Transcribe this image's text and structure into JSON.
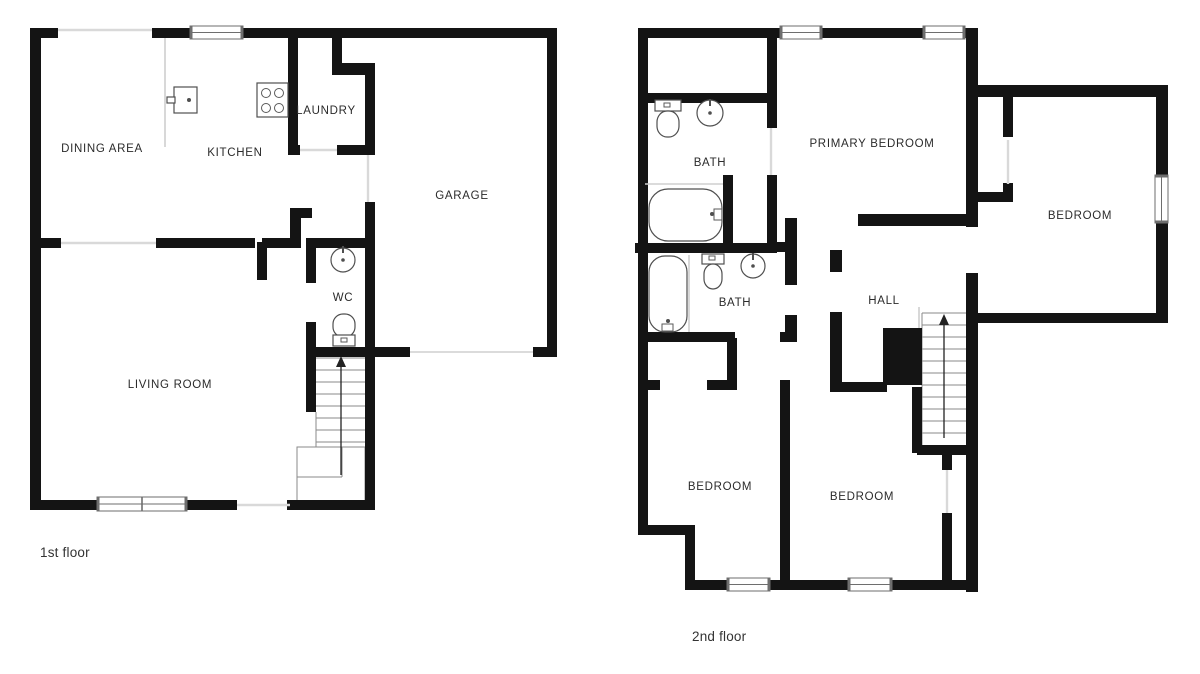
{
  "document": {
    "type": "floor-plan",
    "background": "#ffffff"
  },
  "colors": {
    "wall": "#141414",
    "window_frame": "#6e6e6e",
    "opening_line": "#d9d9d9",
    "label": "#2b2b2b"
  },
  "floor1": {
    "caption": "1st floor",
    "rooms": {
      "dining": {
        "label": "DINING AREA"
      },
      "kitchen": {
        "label": "KITCHEN"
      },
      "laundry": {
        "label": "LAUNDRY"
      },
      "garage": {
        "label": "GARAGE"
      },
      "wc": {
        "label": "WC"
      },
      "living": {
        "label": "LIVING ROOM"
      }
    },
    "fixtures": [
      "kitchen-sink",
      "stove",
      "wc-sink",
      "toilet",
      "staircase-up"
    ],
    "windows": 2,
    "stair_direction": "up"
  },
  "floor2": {
    "caption": "2nd floor",
    "rooms": {
      "bath_upper": {
        "label": "BATH"
      },
      "primary": {
        "label": "PRIMARY BEDROOM"
      },
      "bedroom_right": {
        "label": "BEDROOM"
      },
      "bath_lower": {
        "label": "BATH"
      },
      "hall": {
        "label": "HALL"
      },
      "bedroom_sw": {
        "label": "BEDROOM"
      },
      "bedroom_se": {
        "label": "BEDROOM"
      }
    },
    "fixtures": [
      "toilet",
      "sink",
      "bathtub",
      "bathtub",
      "toilet",
      "sink",
      "staircase-up"
    ],
    "windows": 5,
    "stair_direction": "up"
  }
}
